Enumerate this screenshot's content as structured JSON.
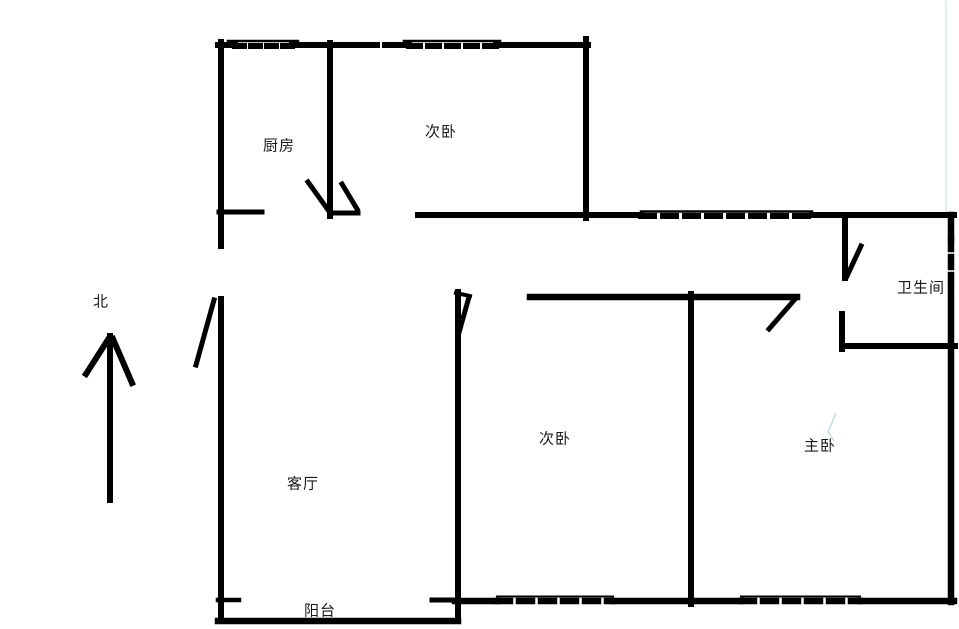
{
  "compass": {
    "label": "北"
  },
  "rooms": {
    "kitchen": {
      "label": "厨房"
    },
    "bedroom_top": {
      "label": "次卧"
    },
    "bathroom": {
      "label": "卫生间"
    },
    "living": {
      "label": "客厅"
    },
    "bedroom_mid": {
      "label": "次卧"
    },
    "master": {
      "label": "主卧"
    },
    "balcony": {
      "label": "阳台"
    }
  },
  "colors": {
    "wall": "#000000",
    "background": "#ffffff",
    "text": "#1a1a1a",
    "canvas_edge": "#dde6f2"
  }
}
